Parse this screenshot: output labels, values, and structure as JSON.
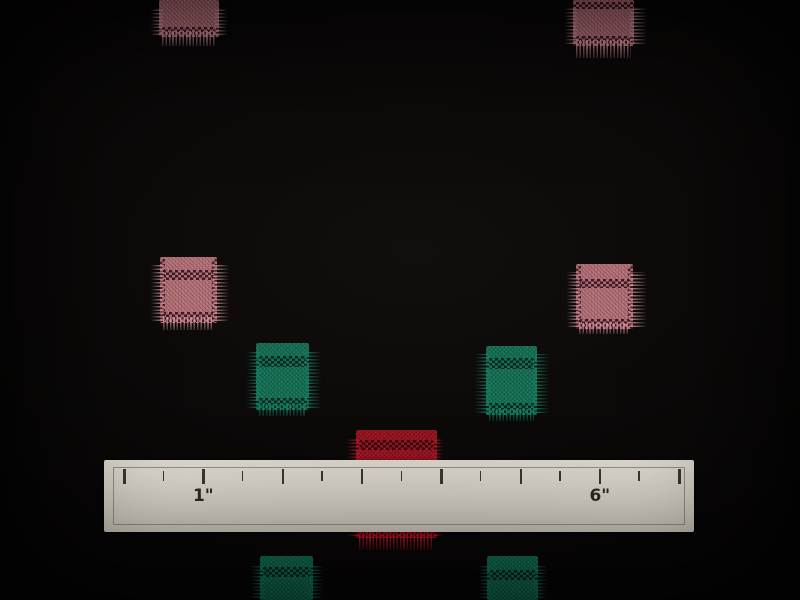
{
  "scene": {
    "description": "Black woven fabric with pink, green and red clip-spot squares; a white inch ruler lies across the lower third",
    "background_color": "#080606"
  },
  "colors": {
    "pink": {
      "base": "#cb7b85",
      "fringe": "#e2a0a8",
      "band": "#381020"
    },
    "green": {
      "base": "#0d7a5b",
      "fringe": "#13876a",
      "band": "#03221a"
    },
    "red": {
      "base": "#a30d1c",
      "fringe": "#c41527",
      "band": "#2e050a"
    },
    "ruler_face": "#dcd7cb",
    "ruler_frame": "#97938a",
    "ruler_tick": "#3a372f"
  },
  "patches": [
    {
      "id": "pink-top-left",
      "color": "pink",
      "left": 150,
      "top": 0,
      "width": 78,
      "height": 46,
      "fringe_left": 9,
      "fringe_right": 9,
      "fringe_top": 0,
      "fringe_bottom": 9,
      "side_fringes": true,
      "side_bands": false,
      "bands": [
        {
          "top": 27,
          "height": 10
        }
      ]
    },
    {
      "id": "pink-top-right",
      "color": "pink",
      "left": 564,
      "top": 0,
      "width": 84,
      "height": 58,
      "fringe_left": 9,
      "fringe_right": 14,
      "fringe_top": 0,
      "fringe_bottom": 12,
      "side_fringes": true,
      "side_bands": false,
      "bands": [
        {
          "top": 2,
          "height": 7
        },
        {
          "top": 36,
          "height": 10
        }
      ]
    },
    {
      "id": "pink-mid-left",
      "color": "pink",
      "left": 150,
      "top": 257,
      "width": 80,
      "height": 73,
      "fringe_left": 10,
      "fringe_right": 13,
      "fringe_top": 0,
      "fringe_bottom": 7,
      "side_fringes": true,
      "side_bands": true,
      "bands": [
        {
          "top": 13,
          "height": 10
        },
        {
          "top": 55,
          "height": 11
        }
      ]
    },
    {
      "id": "pink-mid-right",
      "color": "pink",
      "left": 566,
      "top": 264,
      "width": 82,
      "height": 70,
      "fringe_left": 10,
      "fringe_right": 15,
      "fringe_top": 0,
      "fringe_bottom": 5,
      "side_fringes": true,
      "side_bands": true,
      "bands": [
        {
          "top": 15,
          "height": 9
        },
        {
          "top": 55,
          "height": 10
        }
      ]
    },
    {
      "id": "green-center-left",
      "color": "green",
      "left": 246,
      "top": 343,
      "width": 76,
      "height": 73,
      "fringe_left": 10,
      "fringe_right": 13,
      "fringe_top": 0,
      "fringe_bottom": 6,
      "side_fringes": true,
      "side_bands": false,
      "bands": [
        {
          "top": 13,
          "height": 11
        },
        {
          "top": 55,
          "height": 12
        }
      ]
    },
    {
      "id": "green-center-right",
      "color": "green",
      "left": 474,
      "top": 346,
      "width": 76,
      "height": 75,
      "fringe_left": 12,
      "fringe_right": 13,
      "fringe_top": 0,
      "fringe_bottom": 6,
      "side_fringes": true,
      "side_bands": false,
      "bands": [
        {
          "top": 12,
          "height": 11
        },
        {
          "top": 57,
          "height": 12
        }
      ]
    },
    {
      "id": "red-center",
      "color": "red",
      "left": 346,
      "top": 430,
      "width": 98,
      "height": 120,
      "fringe_left": 10,
      "fringe_right": 7,
      "fringe_top": 0,
      "fringe_bottom": 12,
      "side_fringes": true,
      "side_bands": false,
      "bands": [
        {
          "top": 10,
          "height": 10
        },
        {
          "top": 99,
          "height": 8
        }
      ]
    },
    {
      "id": "green-bottom-left",
      "color": "green",
      "left": 250,
      "top": 556,
      "width": 74,
      "height": 44,
      "fringe_left": 10,
      "fringe_right": 11,
      "fringe_top": 0,
      "fringe_bottom": 0,
      "side_fringes": true,
      "side_bands": false,
      "bands": [
        {
          "top": 11,
          "height": 10
        }
      ]
    },
    {
      "id": "green-bottom-right",
      "color": "green",
      "left": 478,
      "top": 556,
      "width": 70,
      "height": 44,
      "fringe_left": 9,
      "fringe_right": 10,
      "fringe_top": 0,
      "fringe_bottom": 0,
      "side_fringes": true,
      "side_bands": false,
      "bands": [
        {
          "top": 14,
          "height": 10
        }
      ]
    }
  ],
  "ruler": {
    "left": 104,
    "top": 460,
    "width": 590,
    "height": 72,
    "tick_count": 15,
    "first_tick_x": 19,
    "half_inch_px": 39.65,
    "labels": [
      {
        "text": "1\"",
        "tick_index": 2
      },
      {
        "text": "6\"",
        "tick_index": 12
      }
    ]
  }
}
